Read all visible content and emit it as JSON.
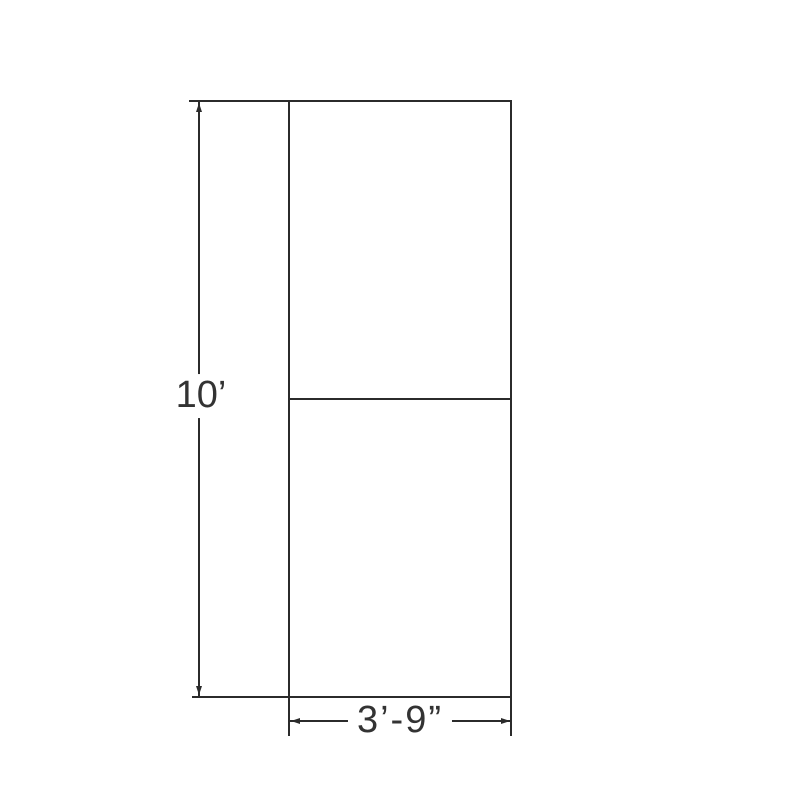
{
  "colors": {
    "background": "#ffffff",
    "line": "#2b2b2b",
    "text": "#333333"
  },
  "drawing": {
    "description": "Elevation of a tall rectangular panel split into two equal sections by a horizontal divider",
    "dimensions": {
      "height_label": "10’",
      "width_label": "3’-9”"
    }
  }
}
